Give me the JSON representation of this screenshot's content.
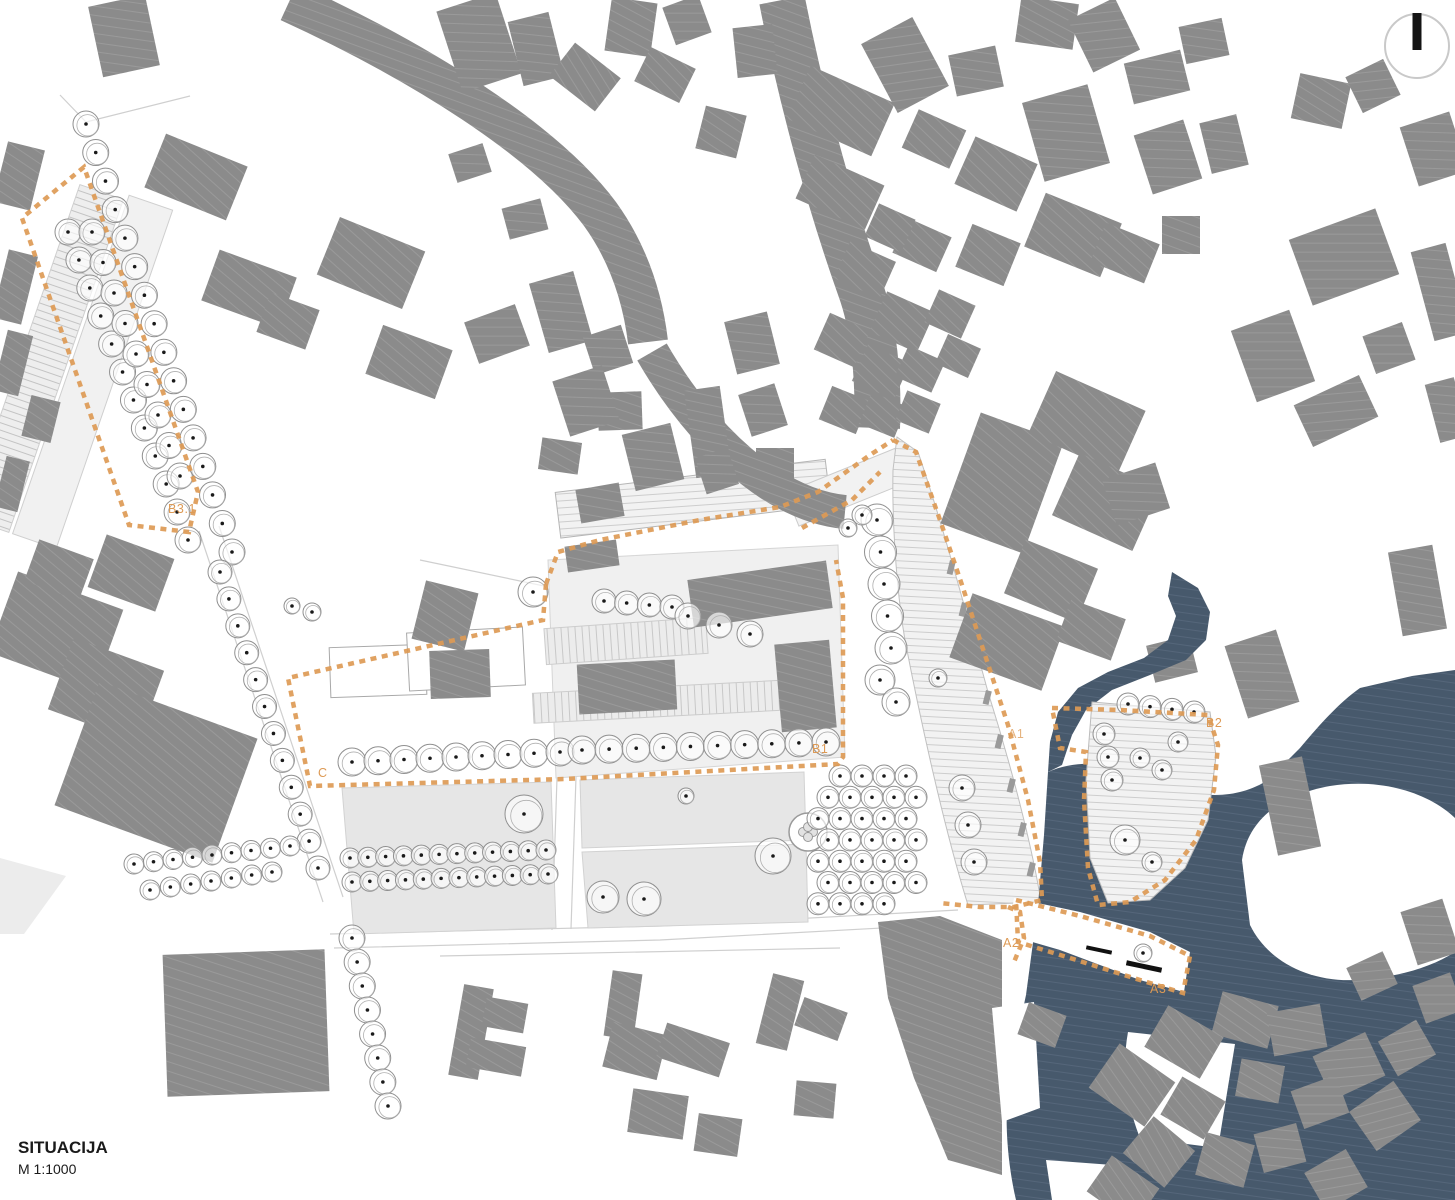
{
  "title_block": {
    "title": "SITUACIJA",
    "scale": "M 1:1000"
  },
  "zone_labels": {
    "b31": "B3.1",
    "c": "C",
    "b1": "B1",
    "a1": "A1",
    "a2": "A2",
    "a3": "A3",
    "b2": "B2"
  },
  "north_indicator": {
    "name": "north-arrow"
  },
  "colors": {
    "building_gray": "#8b8b8b",
    "building_hatch": "#9a9a9a",
    "context_dark_blue": "#47596c",
    "context_dark_hatch": "#5c6e82",
    "boundary_orange": "#dd9a55",
    "lawn": "#e6e6e6",
    "paving": "#f0f0f0",
    "tree_outline": "#8f8f8f",
    "road_line": "#cfcfcf",
    "text_dark": "#1a1a1a"
  }
}
